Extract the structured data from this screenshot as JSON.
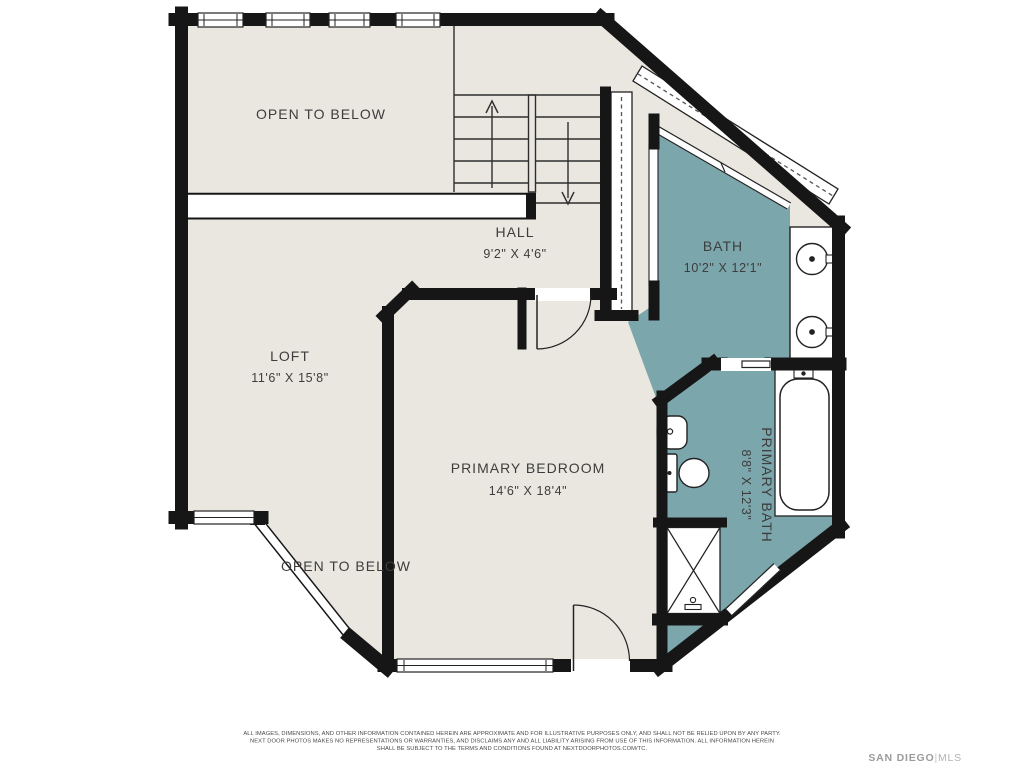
{
  "colors": {
    "floor": "#e9e7df",
    "wet_floor": "#7ba6ac",
    "wall": "#161616",
    "background": "#ffffff",
    "label": "#3d3d3d",
    "brand_gray": "#9e9e9e"
  },
  "rooms": {
    "open_to_below_top": {
      "label": "OPEN TO BELOW"
    },
    "hall": {
      "label": "HALL",
      "dims": "9'2\" X 4'6\""
    },
    "bath": {
      "label": "BATH",
      "dims": "10'2\" X 12'1\""
    },
    "loft": {
      "label": "LOFT",
      "dims": "11'6\" X 15'8\""
    },
    "primary_bedroom": {
      "label": "PRIMARY BEDROOM",
      "dims": "14'6\" X 18'4\""
    },
    "primary_bath": {
      "label": "PRIMARY BATH",
      "dims": "8'8\" X 12'3\""
    },
    "open_to_below_bottom": {
      "label": "OPEN TO BELOW"
    }
  },
  "icons": {
    "stairs_up_arrow": "up-direction arrow on left stair flight",
    "stairs_down_arrow": "down-direction arrow on right stair flight",
    "fixtures": [
      "double-vanity-sink",
      "double-vanity-sink",
      "bathtub",
      "toilet",
      "pedestal-sink",
      "shower",
      "closet-rod",
      "closet-rod",
      "sliding-door",
      "pocket-door"
    ]
  },
  "footer": {
    "disclaimer_lines": [
      "ALL IMAGES, DIMENSIONS, AND OTHER INFORMATION CONTAINED HEREIN ARE APPROXIMATE AND FOR ILLUSTRATIVE PURPOSES ONLY, AND SHALL NOT BE RELIED UPON BY ANY PARTY.",
      "NEXT DOOR PHOTOS MAKES NO REPRESENTATIONS OR WARRANTIES, AND DISCLAIMS ANY AND ALL LIABILITY ARISING FROM USE OF THIS INFORMATION. ALL INFORMATION HEREIN",
      "SHALL BE SUBJECT TO THE TERMS AND CONDITIONS FOUND AT NEXTDOORPHOTOS.COM/TC."
    ],
    "brand": {
      "name": "SAN DIEGO",
      "separator": "|",
      "suffix": "MLS"
    }
  }
}
